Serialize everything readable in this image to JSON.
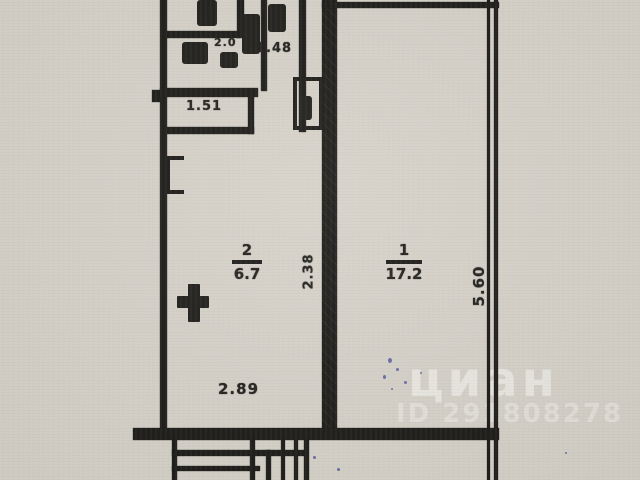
{
  "plan": {
    "rooms": [
      {
        "number": "1",
        "area": "17.2"
      },
      {
        "number": "2",
        "area": "6.7"
      }
    ],
    "dimensions": {
      "bath_width": "1.48",
      "hall_width": "1.51",
      "wc_width": "2.0",
      "room2_width": "2.38",
      "room1_depth": "5.60",
      "room2_bottom_width": "2.89"
    }
  },
  "watermark": {
    "brand": "циан",
    "id_number": "ID 291808278"
  },
  "colors": {
    "paper": "#d6d2c9",
    "ink": "#1d1c19",
    "watermark_text": "#fbfaf6",
    "pen_ink": "#575c9f"
  }
}
